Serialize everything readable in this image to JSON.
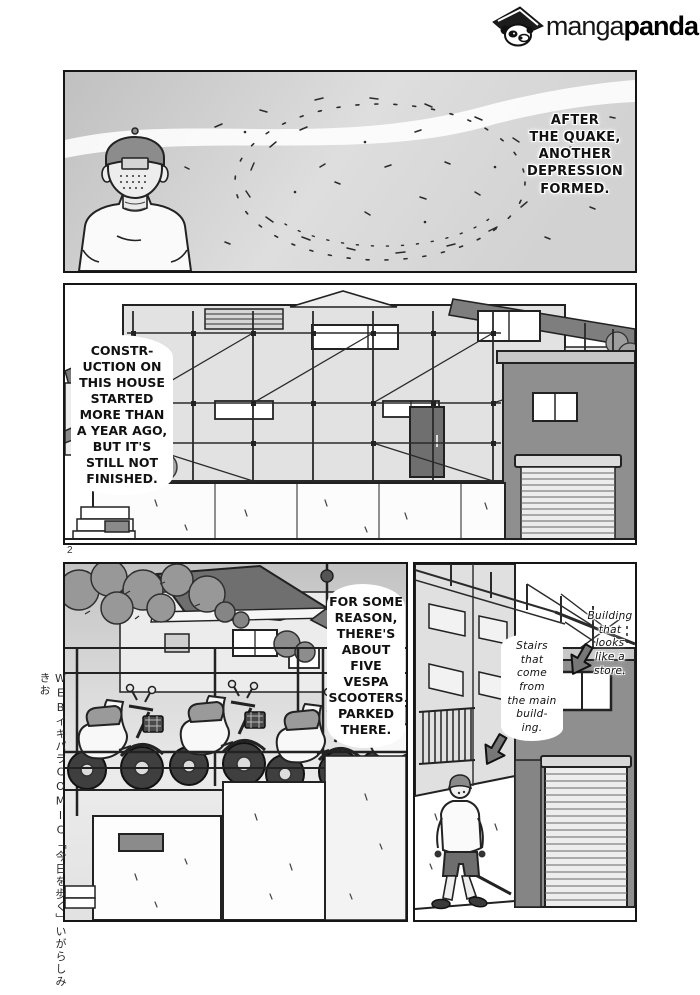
{
  "brand": {
    "manga": "manga",
    "panda": "panda",
    "icon": "panda-with-hat-icon"
  },
  "page": {
    "number": "2",
    "credit": "WEBイキパラCOMIC「今日を歩く」いがらしみきお"
  },
  "captions": {
    "p1": "AFTER\nTHE QUAKE,\nANOTHER\nDEPRESSION\nFORMED.",
    "p2": "CONSTR-\nUCTION ON\nTHIS HOUSE\nSTARTED\nMORE THAN\nA YEAR AGO,\nBUT IT'S\nSTILL NOT\nFINISHED.",
    "p3": "FOR SOME\nREASON,\nTHERE'S\nABOUT FIVE\nVESPA\nSCOOTERS\nPARKED\nTHERE.",
    "p4_stairs": "Stairs\nthat\ncome\nfrom\nthe main\nbuild-\ning.",
    "p4_building": "Building\nthat\nlooks\nlike a\nstore."
  },
  "colors": {
    "ink": "#1a1a1a",
    "panel_gray": "#d2d2d2",
    "dark_gray": "#8f8f8f",
    "paper": "#ffffff"
  }
}
